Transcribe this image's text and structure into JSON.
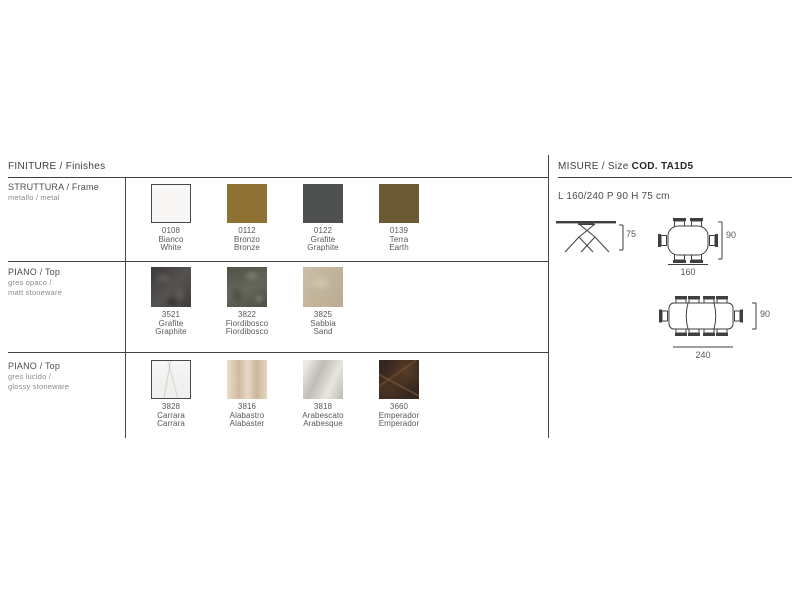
{
  "finishes": {
    "title": "FINITURE / Finishes",
    "rows": [
      {
        "label": "STRUTTURA / Frame",
        "sub1": "metallo / metal",
        "sub2": "",
        "swatches": [
          {
            "code": "0108",
            "it": "Bianco",
            "en": "White",
            "color": "#f8f7f5"
          },
          {
            "code": "0112",
            "it": "Bronzo",
            "en": "Bronze",
            "color": "#8d7234"
          },
          {
            "code": "0122",
            "it": "Grafite",
            "en": "Graphite",
            "color": "#4e504f"
          },
          {
            "code": "0139",
            "it": "Terra",
            "en": "Earth",
            "color": "#6b5a33"
          }
        ]
      },
      {
        "label": "PIANO / Top",
        "sub1": "gres opaco /",
        "sub2": "matt stoneware",
        "swatches": [
          {
            "code": "3521",
            "it": "Grafite",
            "en": "Graphite",
            "color": "#4a4745"
          },
          {
            "code": "3822",
            "it": "Fiordibosco",
            "en": "Fiordibosco",
            "color": "#5c5e50"
          },
          {
            "code": "3825",
            "it": "Sabbia",
            "en": "Sand",
            "color": "#c3b59b"
          }
        ]
      },
      {
        "label": "PIANO / Top",
        "sub1": "gres lucido /",
        "sub2": "glossy stoneware",
        "swatches": [
          {
            "code": "3828",
            "it": "Carrara",
            "en": "Carrara",
            "color": "#f1f0ee"
          },
          {
            "code": "3816",
            "it": "Alabastro",
            "en": "Alabaster",
            "color": "#ddc9ae"
          },
          {
            "code": "3818",
            "it": "Arabescato",
            "en": "Arabesque",
            "color": "#d4d1c9"
          },
          {
            "code": "3660",
            "it": "Emperador",
            "en": "Emperador",
            "color": "#352720"
          }
        ]
      }
    ]
  },
  "size": {
    "title_prefix": "MISURE / Size ",
    "code": "COD. TA1D5",
    "dimensions": "L 160/240 P 90 H 75 cm",
    "labels": {
      "height": "75",
      "depth": "90",
      "width_closed": "160",
      "width_open": "240"
    }
  },
  "colors": {
    "line": "#3f3f41",
    "text": "#4d4d4f",
    "label": "#58585b"
  }
}
